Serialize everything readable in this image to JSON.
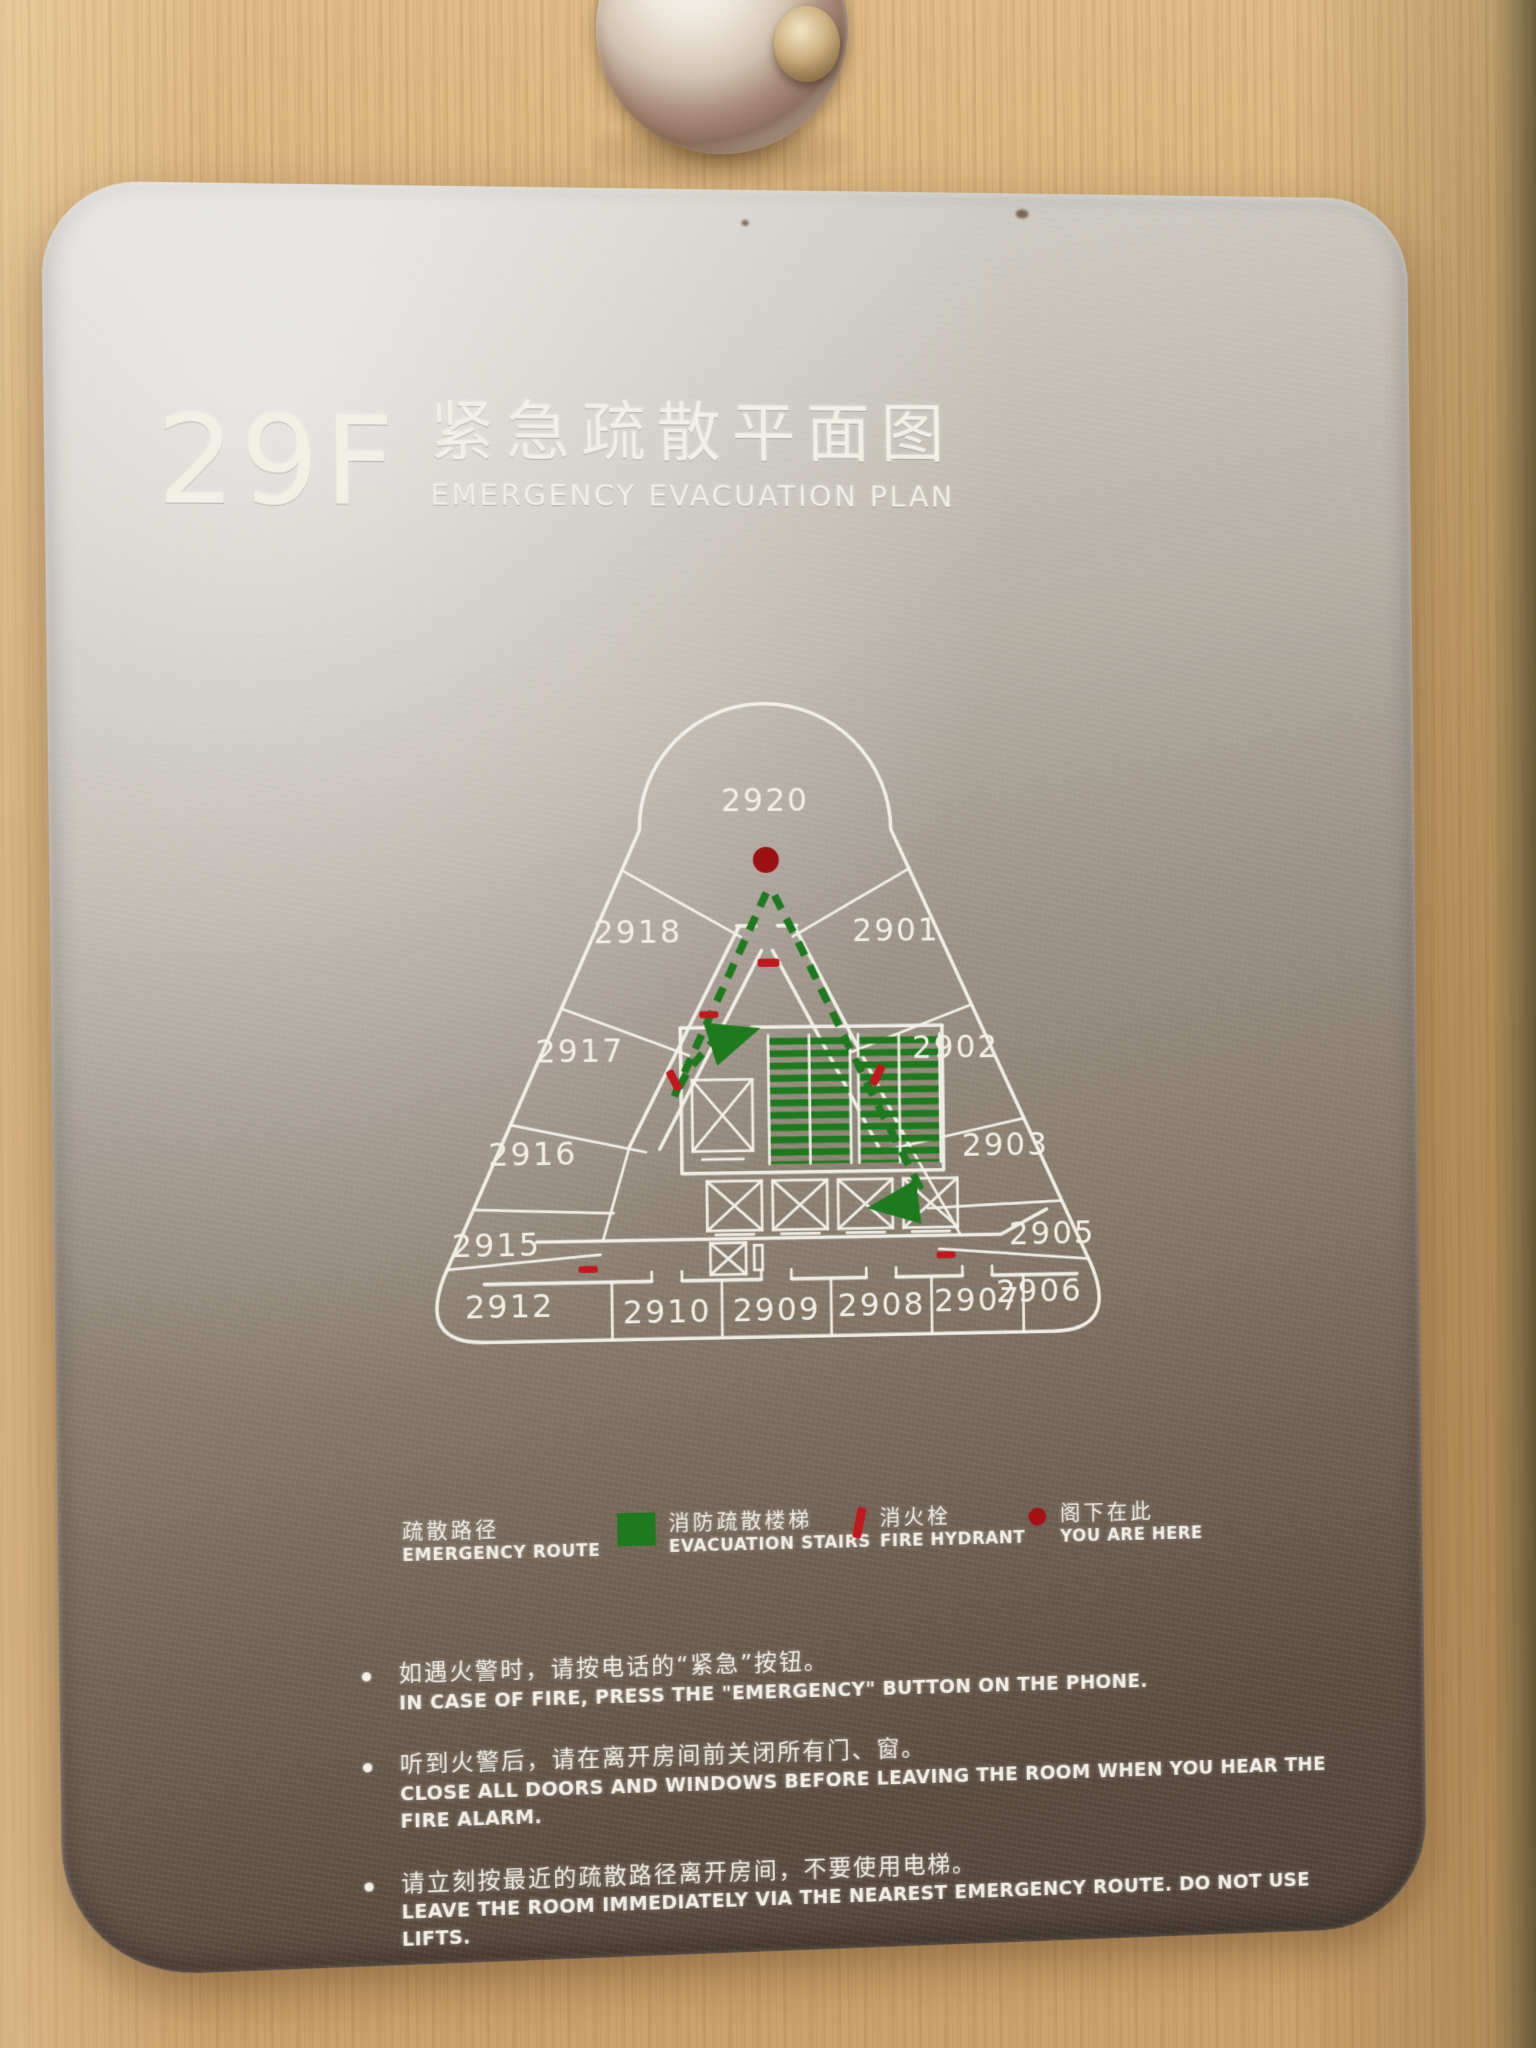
{
  "sign": {
    "floor_label": "29F",
    "title_zh": "紧急疏散平面图",
    "title_en": "EMERGENCY EVACUATION PLAN"
  },
  "colors": {
    "route_green": "#1e7a1e",
    "stairs_green": "#1e7a1e",
    "hydrant_red": "#c0181c",
    "you_are_here_red": "#a50f15",
    "plan_line": "#f3f1ea"
  },
  "floor_plan": {
    "rooms": [
      {
        "number": "2920"
      },
      {
        "number": "2918"
      },
      {
        "number": "2901"
      },
      {
        "number": "2917"
      },
      {
        "number": "2902"
      },
      {
        "number": "2916"
      },
      {
        "number": "2903"
      },
      {
        "number": "2915"
      },
      {
        "number": "2905"
      },
      {
        "number": "2912"
      },
      {
        "number": "2910"
      },
      {
        "number": "2909"
      },
      {
        "number": "2908"
      },
      {
        "number": "2907"
      },
      {
        "number": "2906"
      }
    ]
  },
  "legend": {
    "items": [
      {
        "icon": "none",
        "zh": "疏散路径",
        "en": "EMERGENCY ROUTE"
      },
      {
        "icon": "green-square",
        "zh": "消防疏散楼梯",
        "en": "EVACUATION STAIRS"
      },
      {
        "icon": "red-bar",
        "zh": "消火栓",
        "en": "FIRE HYDRANT"
      },
      {
        "icon": "red-dot",
        "zh": "阁下在此",
        "en": "YOU ARE HERE"
      }
    ]
  },
  "instructions": [
    {
      "zh": "如遇火警时，请按电话的“紧急”按钮。",
      "en": "IN CASE OF FIRE, PRESS THE \"EMERGENCY\" BUTTON ON THE PHONE."
    },
    {
      "zh": "听到火警后，请在离开房间前关闭所有门、窗。",
      "en": "CLOSE ALL DOORS AND WINDOWS BEFORE LEAVING THE ROOM WHEN YOU HEAR THE FIRE ALARM."
    },
    {
      "zh": "请立刻按最近的疏散路径离开房间，不要使用电梯。",
      "en": "LEAVE THE ROOM IMMEDIATELY VIA THE NEAREST EMERGENCY ROUTE. DO NOT USE LIFTS."
    }
  ]
}
